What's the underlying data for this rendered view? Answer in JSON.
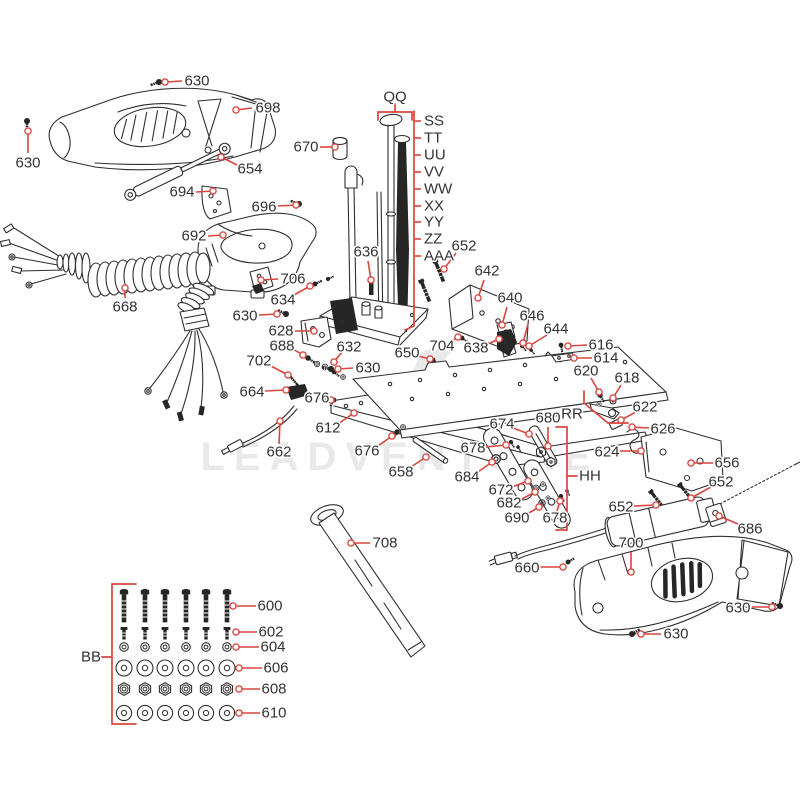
{
  "diagram": {
    "kind": "exploded-parts-diagram"
  },
  "watermark": {
    "text": "LEADVENTURE"
  },
  "colors": {
    "leader": "#d9463e",
    "line": "#2f2f2f",
    "label": "#333333",
    "watermark": "#e9e9e9"
  },
  "group_labels": [
    {
      "text": "QQ",
      "x": 395,
      "y": 97
    },
    {
      "text": "RR",
      "x": 572,
      "y": 414
    },
    {
      "text": "HH",
      "x": 590,
      "y": 476
    },
    {
      "text": "BB",
      "x": 91,
      "y": 657
    }
  ],
  "letter_column": {
    "bracket_x": 414,
    "text_x": 424,
    "top": 111,
    "bottom": 326,
    "labels": [
      {
        "text": "SS",
        "y": 121
      },
      {
        "text": "TT",
        "y": 138
      },
      {
        "text": "UU",
        "y": 155
      },
      {
        "text": "VV",
        "y": 172
      },
      {
        "text": "WW",
        "y": 189
      },
      {
        "text": "XX",
        "y": 206
      },
      {
        "text": "YY",
        "y": 222
      },
      {
        "text": "ZZ",
        "y": 239
      },
      {
        "text": "AAA",
        "y": 256
      }
    ]
  },
  "callouts": [
    {
      "text": "630",
      "tx": 197,
      "ty": 81,
      "x1": 182,
      "y1": 81,
      "x2": 165,
      "y2": 82
    },
    {
      "text": "698",
      "tx": 268,
      "ty": 108,
      "x1": 252,
      "y1": 108,
      "x2": 236,
      "y2": 110
    },
    {
      "text": "630",
      "tx": 28,
      "ty": 163,
      "x1": 28,
      "y1": 153,
      "x2": 28,
      "y2": 131
    },
    {
      "text": "654",
      "tx": 250,
      "ty": 169,
      "x1": 237,
      "y1": 165,
      "x2": 221,
      "y2": 157
    },
    {
      "text": "694",
      "tx": 182,
      "ty": 192,
      "x1": 196,
      "y1": 192,
      "x2": 213,
      "y2": 191
    },
    {
      "text": "696",
      "tx": 264,
      "ty": 207,
      "x1": 278,
      "y1": 206,
      "x2": 296,
      "y2": 205
    },
    {
      "text": "692",
      "tx": 194,
      "ty": 236,
      "x1": 208,
      "y1": 236,
      "x2": 223,
      "y2": 235
    },
    {
      "text": "670",
      "tx": 306,
      "ty": 147,
      "x1": 320,
      "y1": 147,
      "x2": 335,
      "y2": 147
    },
    {
      "text": "636",
      "tx": 366,
      "ty": 252,
      "x1": 368,
      "y1": 261,
      "x2": 371,
      "y2": 280
    },
    {
      "text": "668",
      "tx": 125,
      "ty": 307,
      "x1": 125,
      "y1": 298,
      "x2": 125,
      "y2": 288
    },
    {
      "text": "706",
      "tx": 293,
      "ty": 279,
      "x1": 278,
      "y1": 279,
      "x2": 261,
      "y2": 280
    },
    {
      "text": "634",
      "tx": 283,
      "ty": 300,
      "x1": 294,
      "y1": 295,
      "x2": 310,
      "y2": 286
    },
    {
      "text": "630",
      "tx": 245,
      "ty": 316,
      "x1": 259,
      "y1": 315,
      "x2": 277,
      "y2": 314
    },
    {
      "text": "628",
      "tx": 281,
      "ty": 331,
      "x1": 295,
      "y1": 331,
      "x2": 314,
      "y2": 331
    },
    {
      "text": "688",
      "tx": 282,
      "ty": 346,
      "x1": 293,
      "y1": 349,
      "x2": 303,
      "y2": 355
    },
    {
      "text": "632",
      "tx": 349,
      "ty": 347,
      "x1": 342,
      "y1": 352,
      "x2": 334,
      "y2": 362
    },
    {
      "text": "702",
      "tx": 259,
      "ty": 361,
      "x1": 271,
      "y1": 366,
      "x2": 288,
      "y2": 375
    },
    {
      "text": "630",
      "tx": 368,
      "ty": 368,
      "x1": 353,
      "y1": 368,
      "x2": 338,
      "y2": 369
    },
    {
      "text": "650",
      "tx": 407,
      "ty": 353,
      "x1": 418,
      "y1": 356,
      "x2": 430,
      "y2": 359
    },
    {
      "text": "704",
      "tx": 442,
      "ty": 346,
      "x1": 450,
      "y1": 342,
      "x2": 458,
      "y2": 337
    },
    {
      "text": "638",
      "tx": 476,
      "ty": 348,
      "x1": 488,
      "y1": 344,
      "x2": 499,
      "y2": 339
    },
    {
      "text": "652",
      "tx": 464,
      "ty": 246,
      "x1": 456,
      "y1": 253,
      "x2": 444,
      "y2": 269
    },
    {
      "text": "642",
      "tx": 487,
      "ty": 271,
      "x1": 484,
      "y1": 280,
      "x2": 478,
      "y2": 298
    },
    {
      "text": "640",
      "tx": 510,
      "ty": 298,
      "x1": 507,
      "y1": 307,
      "x2": 502,
      "y2": 325
    },
    {
      "text": "646",
      "tx": 532,
      "ty": 316,
      "x1": 528,
      "y1": 324,
      "x2": 523,
      "y2": 343
    },
    {
      "text": "644",
      "tx": 556,
      "ty": 329,
      "x1": 547,
      "y1": 335,
      "x2": 529,
      "y2": 346
    },
    {
      "text": "616",
      "tx": 601,
      "ty": 345,
      "x1": 587,
      "y1": 345,
      "x2": 568,
      "y2": 346
    },
    {
      "text": "614",
      "tx": 606,
      "ty": 358,
      "x1": 592,
      "y1": 358,
      "x2": 574,
      "y2": 358
    },
    {
      "text": "620",
      "tx": 586,
      "ty": 371,
      "x1": 591,
      "y1": 378,
      "x2": 599,
      "y2": 392
    },
    {
      "text": "618",
      "tx": 627,
      "ty": 378,
      "x1": 621,
      "y1": 385,
      "x2": 613,
      "y2": 398
    },
    {
      "text": "622",
      "tx": 645,
      "ty": 407,
      "x1": 636,
      "y1": 412,
      "x2": 621,
      "y2": 420
    },
    {
      "text": "626",
      "tx": 663,
      "ty": 429,
      "x1": 649,
      "y1": 428,
      "x2": 632,
      "y2": 427
    },
    {
      "text": "624",
      "tx": 607,
      "ty": 452,
      "x1": 620,
      "y1": 451,
      "x2": 641,
      "y2": 451
    },
    {
      "text": "656",
      "tx": 727,
      "ty": 463,
      "x1": 713,
      "y1": 463,
      "x2": 691,
      "y2": 463
    },
    {
      "text": "652",
      "tx": 721,
      "ty": 482,
      "x1": 711,
      "y1": 487,
      "x2": 691,
      "y2": 498
    },
    {
      "text": "652",
      "tx": 621,
      "ty": 507,
      "x1": 634,
      "y1": 506,
      "x2": 656,
      "y2": 505
    },
    {
      "text": "686",
      "tx": 750,
      "ty": 529,
      "x1": 738,
      "y1": 524,
      "x2": 719,
      "y2": 516
    },
    {
      "text": "700",
      "tx": 631,
      "ty": 543,
      "x1": 631,
      "y1": 552,
      "x2": 631,
      "y2": 572
    },
    {
      "text": "660",
      "tx": 527,
      "ty": 568,
      "x1": 540,
      "y1": 567,
      "x2": 563,
      "y2": 567
    },
    {
      "text": "630",
      "tx": 738,
      "ty": 608,
      "x1": 752,
      "y1": 607,
      "x2": 772,
      "y2": 607
    },
    {
      "text": "630",
      "tx": 676,
      "ty": 634,
      "x1": 661,
      "y1": 634,
      "x2": 641,
      "y2": 634
    },
    {
      "text": "708",
      "tx": 385,
      "ty": 543,
      "x1": 370,
      "y1": 543,
      "x2": 351,
      "y2": 543
    },
    {
      "text": "674",
      "tx": 502,
      "ty": 424,
      "x1": 513,
      "y1": 428,
      "x2": 529,
      "y2": 434
    },
    {
      "text": "680",
      "tx": 548,
      "ty": 418,
      "x1": 548,
      "y1": 427,
      "x2": 548,
      "y2": 446
    },
    {
      "text": "678",
      "tx": 473,
      "ty": 448,
      "x1": 486,
      "y1": 447,
      "x2": 506,
      "y2": 445
    },
    {
      "text": "684",
      "tx": 467,
      "ty": 477,
      "x1": 478,
      "y1": 472,
      "x2": 492,
      "y2": 462
    },
    {
      "text": "672",
      "tx": 501,
      "ty": 490,
      "x1": 512,
      "y1": 487,
      "x2": 528,
      "y2": 481
    },
    {
      "text": "682",
      "tx": 509,
      "ty": 503,
      "x1": 520,
      "y1": 500,
      "x2": 535,
      "y2": 492
    },
    {
      "text": "690",
      "tx": 517,
      "ty": 518,
      "x1": 527,
      "y1": 514,
      "x2": 539,
      "y2": 507
    },
    {
      "text": "678",
      "tx": 555,
      "ty": 518,
      "x1": 557,
      "y1": 511,
      "x2": 560,
      "y2": 501
    },
    {
      "text": "612",
      "tx": 328,
      "ty": 428,
      "x1": 338,
      "y1": 424,
      "x2": 354,
      "y2": 413
    },
    {
      "text": "676",
      "tx": 317,
      "ty": 398,
      "x1": 325,
      "y1": 399,
      "x2": 331,
      "y2": 400
    },
    {
      "text": "676",
      "tx": 367,
      "ty": 451,
      "x1": 378,
      "y1": 446,
      "x2": 392,
      "y2": 436
    },
    {
      "text": "658",
      "tx": 401,
      "ty": 472,
      "x1": 411,
      "y1": 467,
      "x2": 426,
      "y2": 457
    },
    {
      "text": "662",
      "tx": 279,
      "ty": 452,
      "x1": 279,
      "y1": 444,
      "x2": 280,
      "y2": 421
    },
    {
      "text": "664",
      "tx": 252,
      "ty": 392,
      "x1": 265,
      "y1": 391,
      "x2": 286,
      "y2": 390
    },
    {
      "text": "600",
      "tx": 270,
      "ty": 606,
      "x1": 256,
      "y1": 606,
      "x2": 233,
      "y2": 606
    },
    {
      "text": "602",
      "tx": 271,
      "ty": 632,
      "x1": 257,
      "y1": 632,
      "x2": 236,
      "y2": 632
    },
    {
      "text": "604",
      "tx": 273,
      "ty": 647,
      "x1": 259,
      "y1": 647,
      "x2": 236,
      "y2": 647
    },
    {
      "text": "606",
      "tx": 276,
      "ty": 668,
      "x1": 262,
      "y1": 668,
      "x2": 239,
      "y2": 668
    },
    {
      "text": "608",
      "tx": 274,
      "ty": 689,
      "x1": 260,
      "y1": 689,
      "x2": 239,
      "y2": 689
    },
    {
      "text": "610",
      "tx": 274,
      "ty": 713,
      "x1": 260,
      "y1": 713,
      "x2": 239,
      "y2": 713
    }
  ]
}
